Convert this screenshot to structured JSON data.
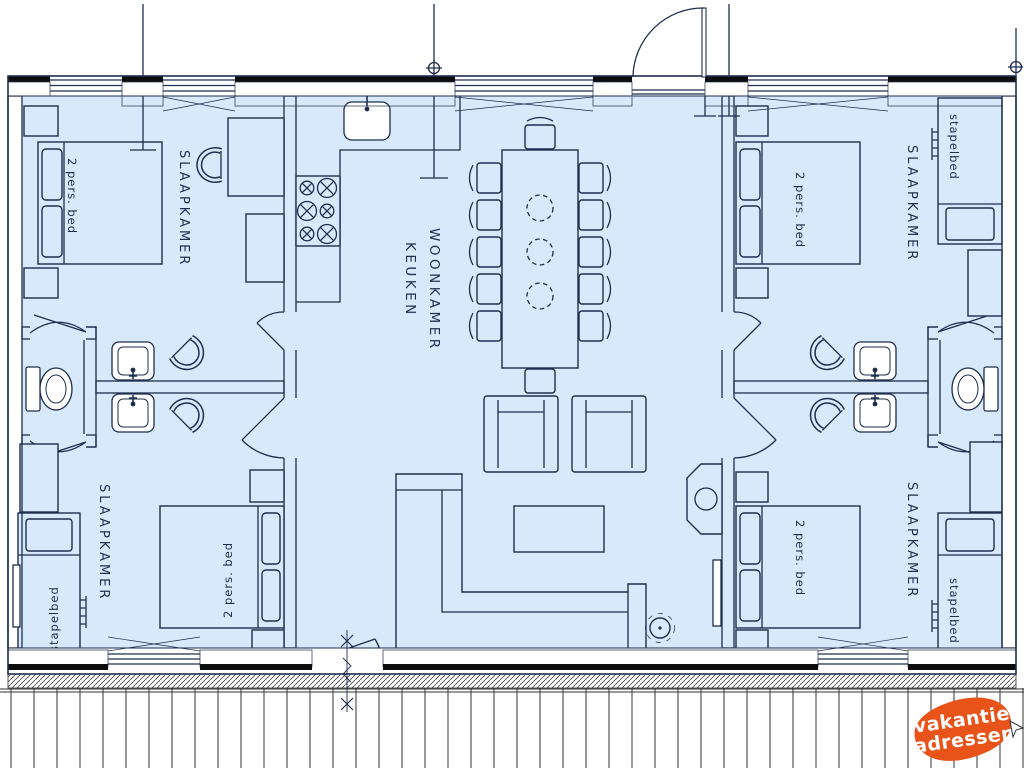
{
  "plan": {
    "type": "vacation-home-floorplan",
    "language": "nl"
  },
  "labels": {
    "slaapkamer": "SLAAPKAMER",
    "woonkamer": "WOONKAMER",
    "keuken": "KEUKEN",
    "double_bed": "2 pers. bed",
    "bunk_bed": "stapelbed"
  },
  "logo": {
    "line1": "vakantie",
    "line2": "adressen",
    "color": "#e8531a",
    "text_color": "#ffffff"
  },
  "colors": {
    "floor": "#d7e9fa",
    "line": "#1e2e4e",
    "wall_fill": "#ffffff",
    "lintel_black": "#0d0d0d",
    "background": "#ffffff"
  }
}
